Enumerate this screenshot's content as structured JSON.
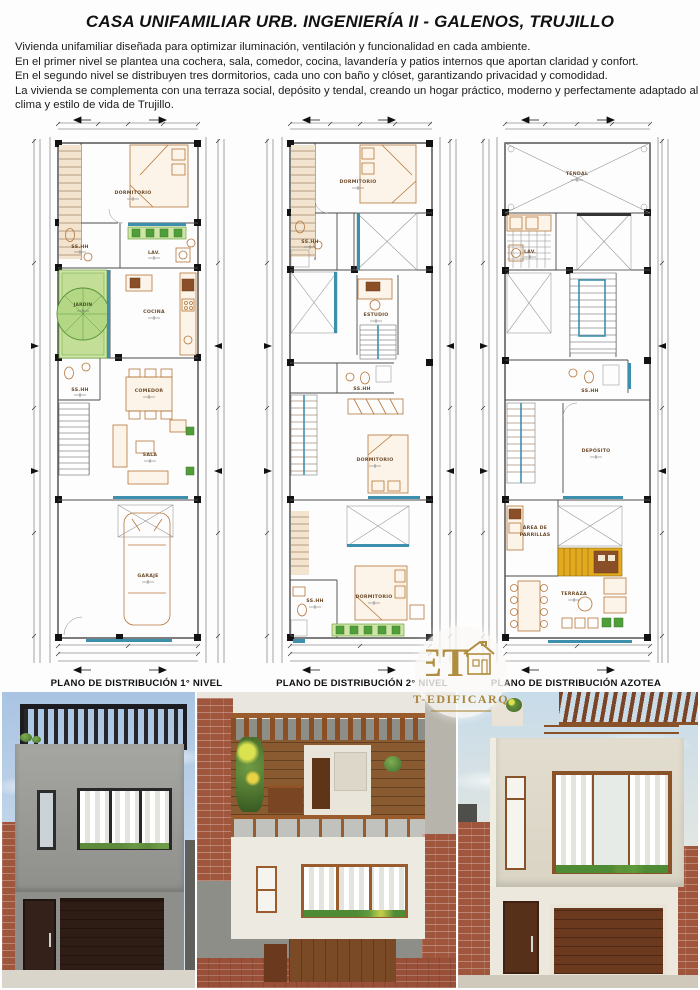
{
  "page": {
    "title": "CASA UNIFAMILIAR URB. INGENIERÍA II - GALENOS, TRUJILLO",
    "description_lines": [
      "Vivienda unifamiliar diseñada para optimizar iluminación, ventilación y funcionalidad en cada ambiente.",
      "En el primer nivel se plantea una cochera, sala, comedor, cocina, lavandería y patios internos que aportan claridad y confort.",
      " En el segundo nivel se distribuyen tres dormitorios, cada uno con baño y clóset, garantizando privacidad y comodidad.",
      " La vivienda se complementa con una terraza social, depósito y tendal, creando un hogar práctico, moderno y perfectamente adaptado al",
      "clima y estilo de vida de Trujillo."
    ]
  },
  "plans": [
    {
      "caption": "PLANO DE DISTRIBUCIÓN 1° NIVEL",
      "rooms": {
        "dormitorio": "DORMITORIO",
        "sshh_1": "SS.HH",
        "lav": "LAV.",
        "jardin": "JARDIN",
        "cocina": "COCINA",
        "sshh_2": "SS.HH",
        "comedor": "COMEDOR",
        "sala": "SALA",
        "garaje": "GARAJE"
      }
    },
    {
      "caption": "PLANO DE DISTRIBUCIÓN 2° NIVEL",
      "rooms": {
        "dormitorio_1": "DORMITORIO",
        "sshh_1": "SS.HH",
        "estudio": "ESTUDIO",
        "sshh_2": "SS.HH",
        "dormitorio_2": "DORMITORIO",
        "dormitorio_3": "DORMITORIO",
        "sshh_3": "SS.HH"
      }
    },
    {
      "caption": "PLANO DE DISTRIBUCIÓN AZOTEA",
      "rooms": {
        "tendal": "TENDAL",
        "lav": "LAV.",
        "sshh": "SS.HH",
        "deposito": "DEPÓSITO",
        "parrillas_1": "ÁREA DE",
        "parrillas_2": "PARRILLAS",
        "terraza": "TERRAZA"
      }
    }
  ],
  "watermark": {
    "monogram": "ET",
    "name": "T-EDIFICARQ"
  },
  "colors": {
    "plan_green": "#6aa83c",
    "plan_blue": "#3d8fae",
    "plan_tan": "#b5763a",
    "parrilla_gold": "#e3aa1f",
    "brick": "#a0563c",
    "pergola_dark": "#222226"
  }
}
